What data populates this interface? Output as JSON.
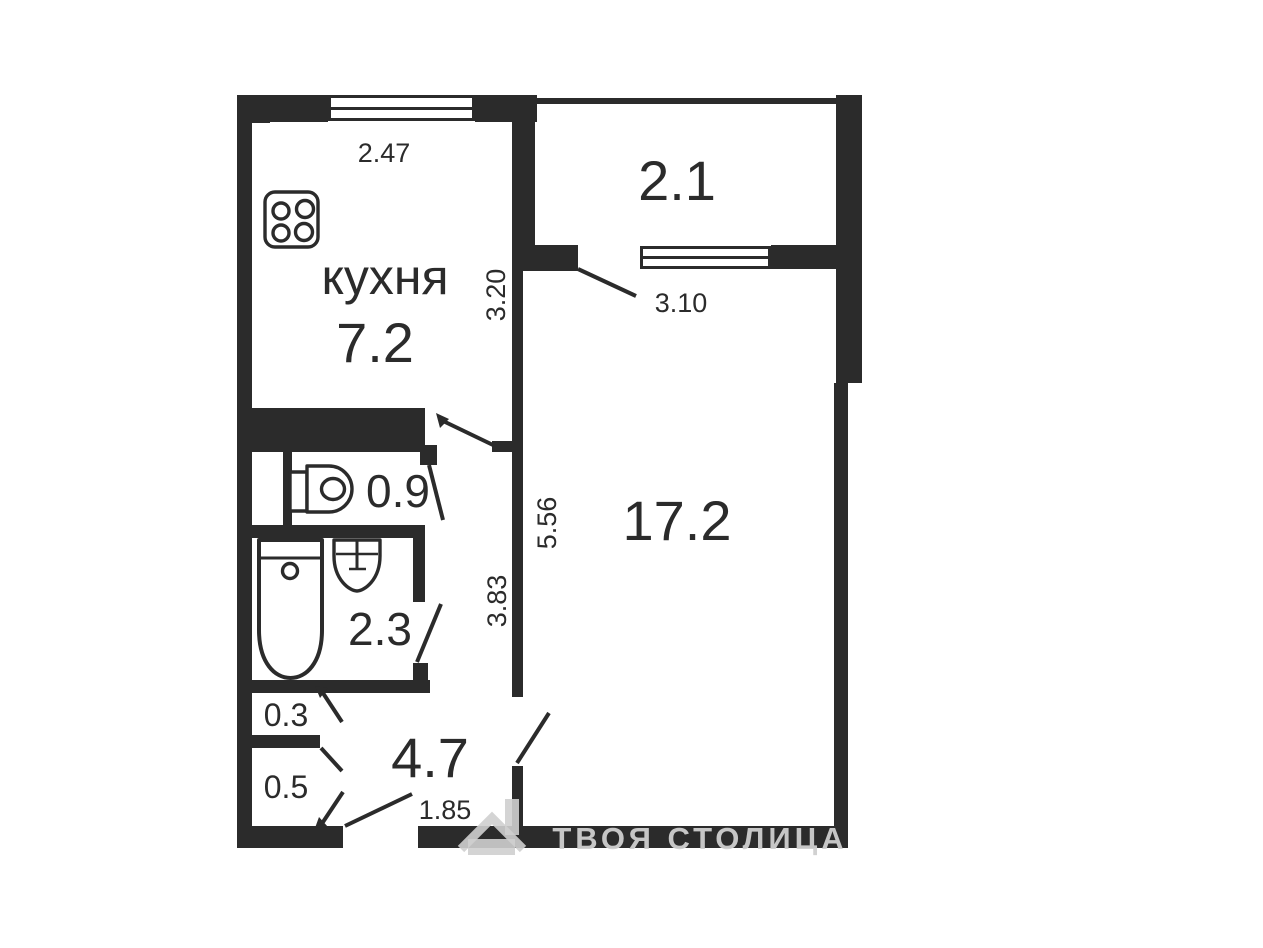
{
  "plan": {
    "rooms": {
      "kitchen": {
        "label": "кухня",
        "area": "7.2"
      },
      "balcony": {
        "area": "2.1"
      },
      "living_room": {
        "area": "17.2"
      },
      "toilet": {
        "area": "0.9"
      },
      "bathroom": {
        "area": "2.3"
      },
      "hallway": {
        "area": "4.7"
      },
      "closet_top": {
        "area": "0.3"
      },
      "closet_bottom": {
        "area": "0.5"
      }
    },
    "dimensions": {
      "kitchen_width": "2.47",
      "kitchen_depth": "3.20",
      "balcony_width": "3.10",
      "living_room_depth": "5.56",
      "hall_depth": "3.83",
      "entrance_width": "1.85"
    },
    "watermark": {
      "text": "ТВОЯ СТОЛИЦА"
    },
    "colors": {
      "wall": "#2b2b2b",
      "background": "#ffffff",
      "watermark": "#cfcfcf"
    }
  }
}
